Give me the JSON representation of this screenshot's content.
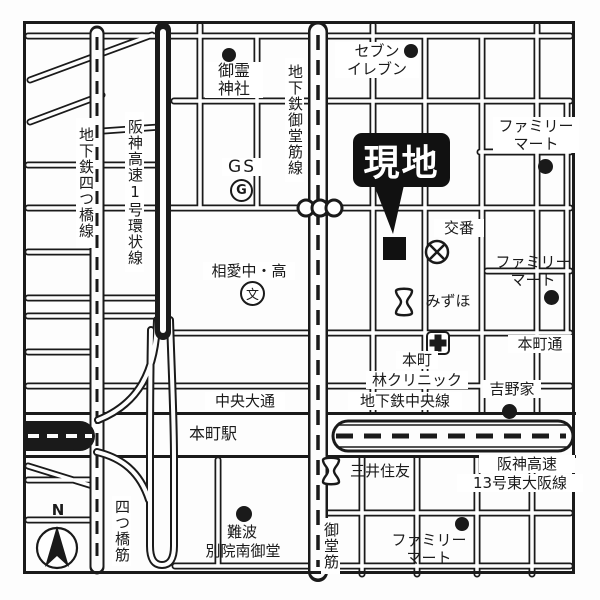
{
  "colors": {
    "ink": "#1a1a1a",
    "paper": "#ffffff"
  },
  "site_marker": {
    "label": "現地"
  },
  "roads": {
    "yotsubashi_suji": "四つ橋筋",
    "midosuji": "御堂筋",
    "chuo_odori": "中央大通",
    "honmachi_dori": "本町通",
    "subway_yotsubashi_line": "地下鉄四つ橋線",
    "subway_midosuji_line": "地下鉄御堂筋線",
    "subway_chuo_line": "地下鉄中央線",
    "hanshin_loop_line": "阪神高速1号環状線",
    "hanshin_13_line1": "阪神高速",
    "hanshin_13_line2": "13号東大阪線",
    "honmachi_station": "本町駅"
  },
  "pois": {
    "goryo_shrine_l1": "御霊",
    "goryo_shrine_l2": "神社",
    "seven_eleven_l1": "セブン",
    "seven_eleven_l2": "イレブン",
    "familymart_l1": "ファミリー",
    "familymart_l2": "マート",
    "gas_station": "GS",
    "gas_station_symbol": "G",
    "koban": "交番",
    "soai_school": "相愛中・高",
    "school_symbol": "文",
    "mizuho": "みずほ",
    "clinic_l1": "本町",
    "clinic_l2": "林クリニック",
    "yoshinoya": "吉野家",
    "smbc": "三井住友",
    "namba_l1": "難波",
    "namba_l2": "別院南御堂"
  },
  "compass": {
    "north": "N"
  }
}
